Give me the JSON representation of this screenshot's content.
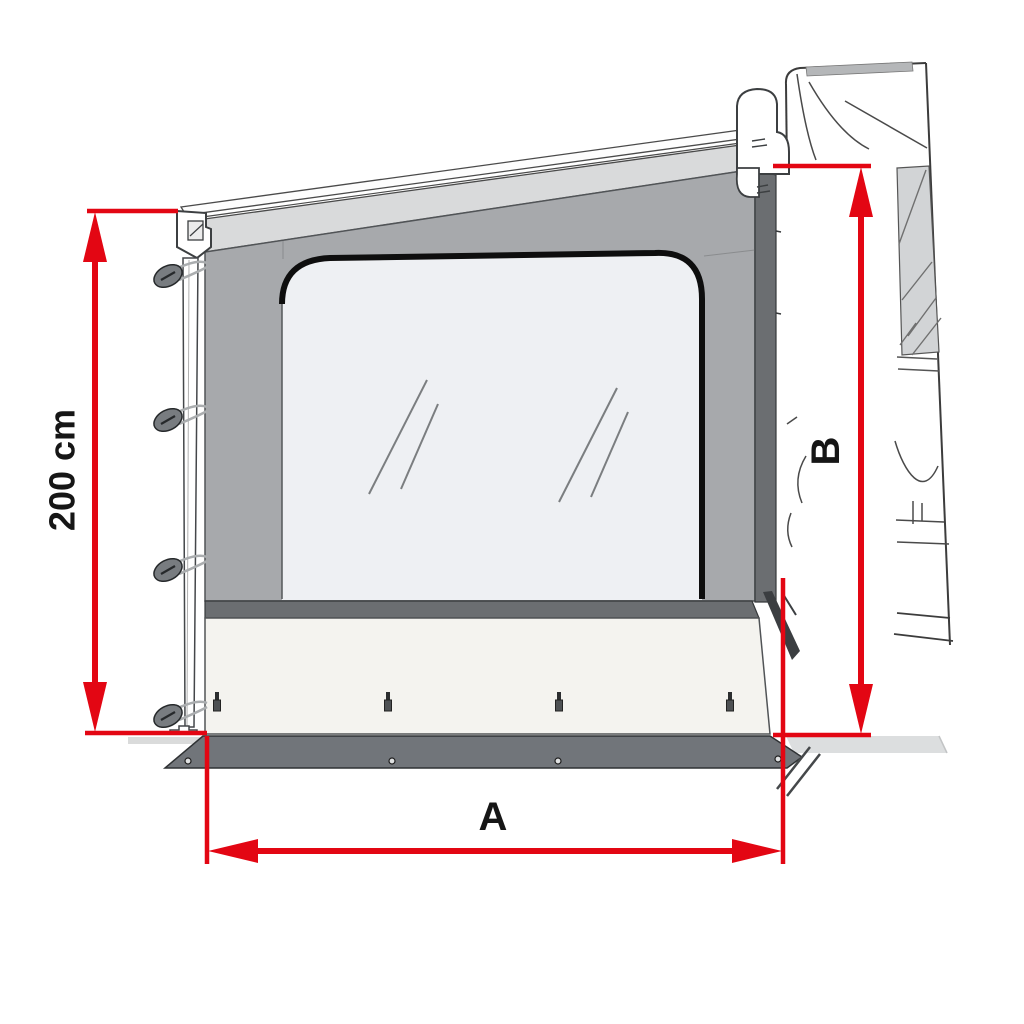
{
  "diagram": {
    "labels": {
      "panel_height": "200 cm",
      "panel_width": "A",
      "attachment_height": "B"
    },
    "colors": {
      "dimension_red": "#e30613",
      "label_black": "#161616",
      "panel_gray": "#a7a9ac",
      "trim_dark_gray": "#6b6e71",
      "valance_gray": "#d9dadb",
      "roof_white": "#fdfdfd",
      "window_glass": "#eef0f3",
      "skirt_offwhite": "#f4f3ef",
      "ground_flap_gray": "#71757a",
      "van_window_tint": "#d2d4d6",
      "ground_gray": "#dcdedf",
      "knob_gray": "#787c80"
    }
  }
}
